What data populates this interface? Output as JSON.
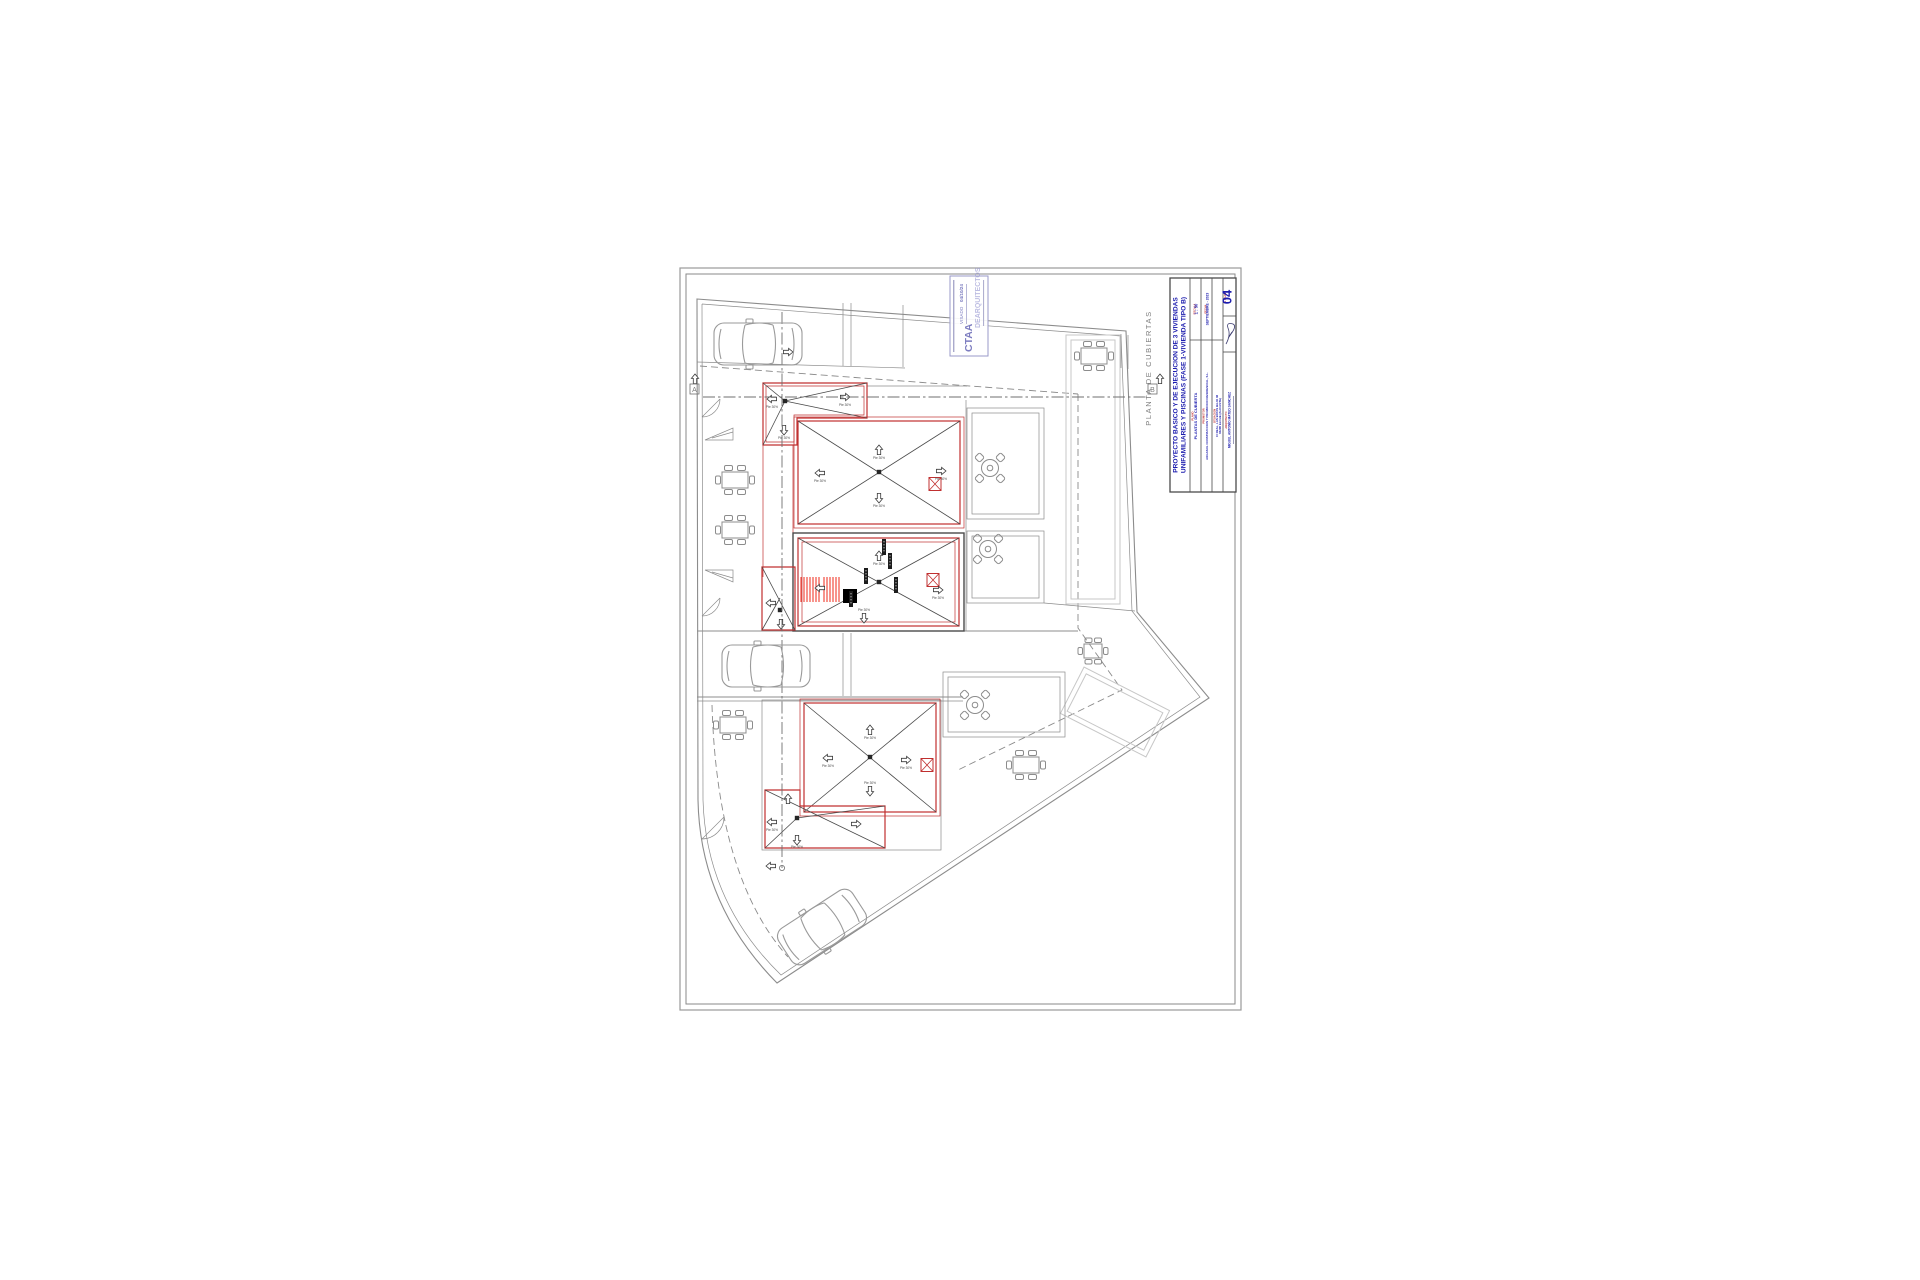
{
  "colors": {
    "gray": "#8c8c8c",
    "dark": "#4a4a4a",
    "light": "#c7c7c7",
    "red": "#c03030",
    "bright": "#ee1republic100",
    "blue": "#1c1cae",
    "stamp": "#7d7dc0"
  },
  "title_block": {
    "project_title_line1": "PROYECTO BASICO Y DE EJECUCION DE 3 VIVIENDAS",
    "project_title_line2": "UNIFAMILIARES Y PISCINAS (FASE 1-VIVIENDA TIPO B)",
    "escala_header": "ESCALA",
    "escala": "1 : 50",
    "plano_header": "PLANO",
    "plano": "PLANTAS DE CUBIERTA",
    "fecha_header": "FECHA",
    "fecha": "SEPTIEMBRE - 2023",
    "promotor_header": "PROMOTOR",
    "promotor": "ARGASOL CONSTRUCCION Y PROMOCION RESIDENCIAL, S.L.",
    "situacion_header": "SITUACION",
    "situacion_line1": "C/ REAL, LAS BAYAS BAJO 46",
    "situacion_line2": "03296 ELCHE (ALICANTE)",
    "arquitecto_header": "ARQUITECTO",
    "arquitecto": "MIGUEL ANTONIO MATEO SANCHEZ",
    "num_plano_header": "N. PLANO",
    "sheet_number": "04"
  },
  "stamp": {
    "org": "CTAA",
    "visado_label": "VISADO",
    "visado_date": "04/10/24",
    "watermark": "DEARQUITECTOS"
  },
  "plan": {
    "view_label": "PLANTA DE CUBIERTAS",
    "section_marker_a": "A",
    "section_marker_b": "B",
    "slope_label": "Pte 30%"
  }
}
